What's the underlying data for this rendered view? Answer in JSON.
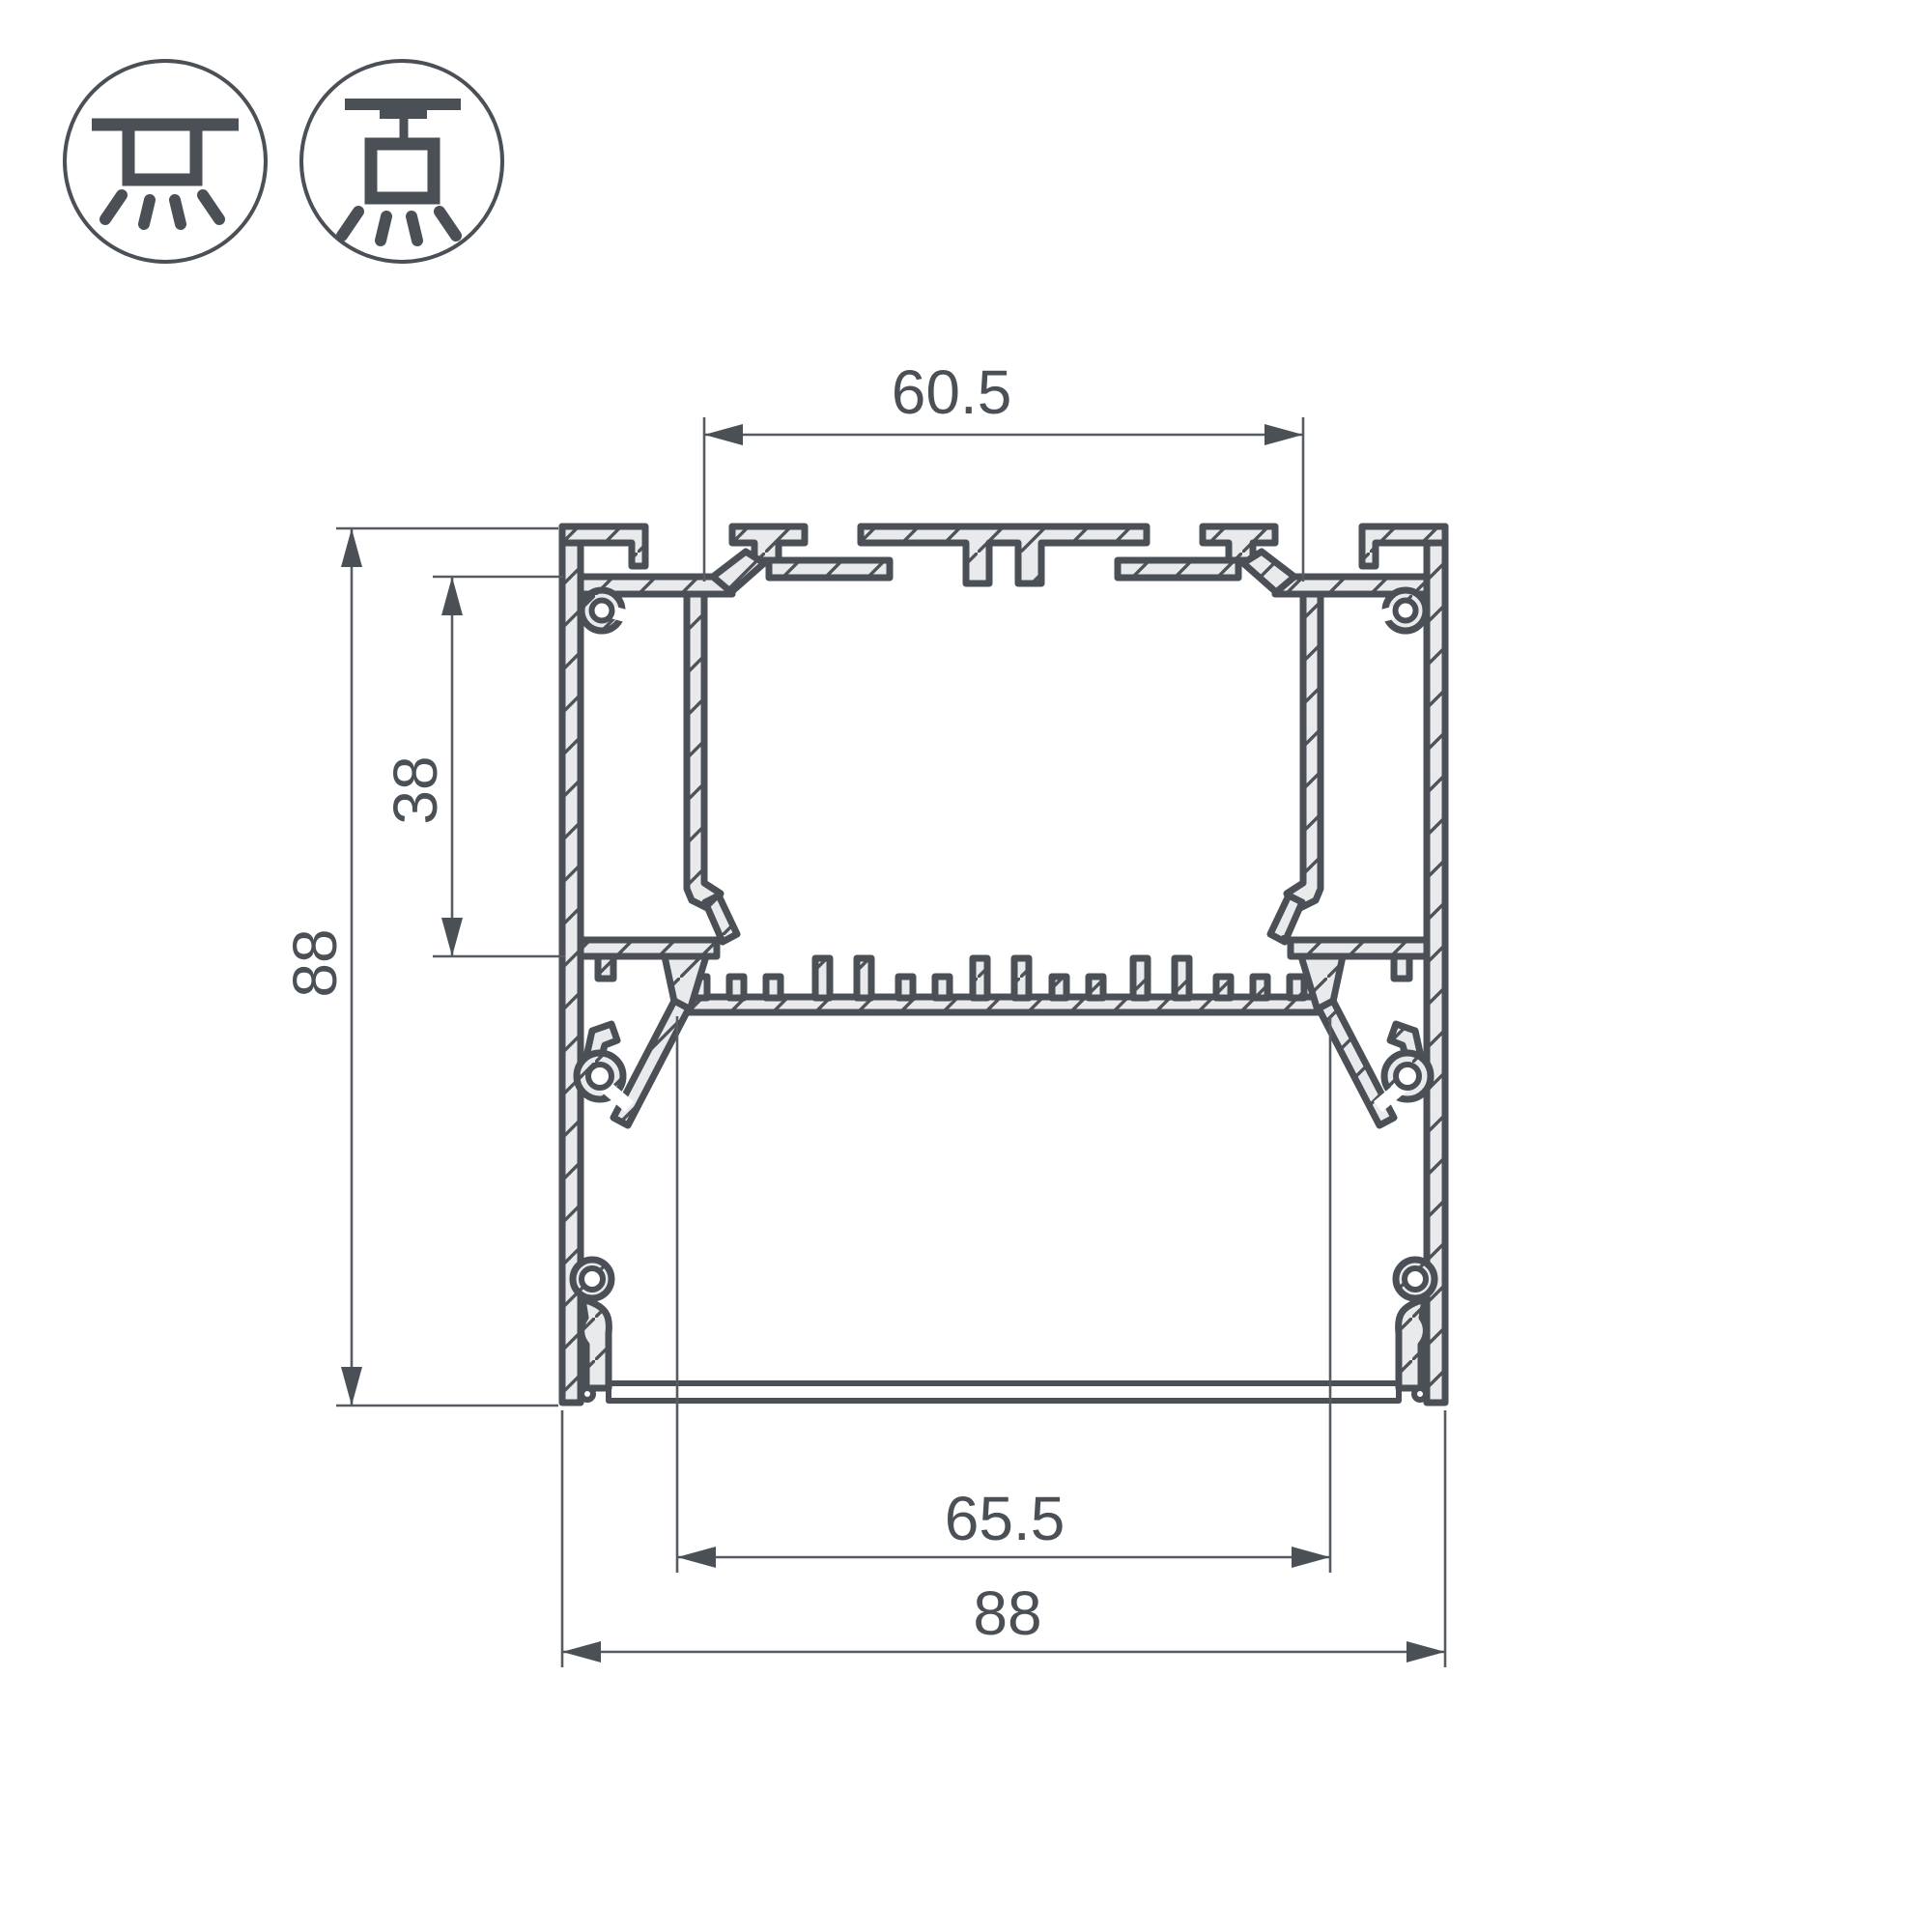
{
  "drawing": {
    "name": "led-profile-cross-section",
    "description": "dimensioned cross-section of extruded aluminum lighting profile"
  },
  "mounting_icons": [
    {
      "id": "surface",
      "name": "surface-ceiling-mount-icon"
    },
    {
      "id": "suspended",
      "name": "suspended-pendant-mount-icon"
    }
  ],
  "dimensions": {
    "top_channel_width": "60.5",
    "upper_section_height": "38",
    "overall_height": "88",
    "inner_width": "65.5",
    "overall_width": "88"
  },
  "colors": {
    "ink": "#4a5056",
    "thin_line": "#565c61",
    "metal_fill": "#e9eaeb",
    "background": "#ffffff"
  }
}
